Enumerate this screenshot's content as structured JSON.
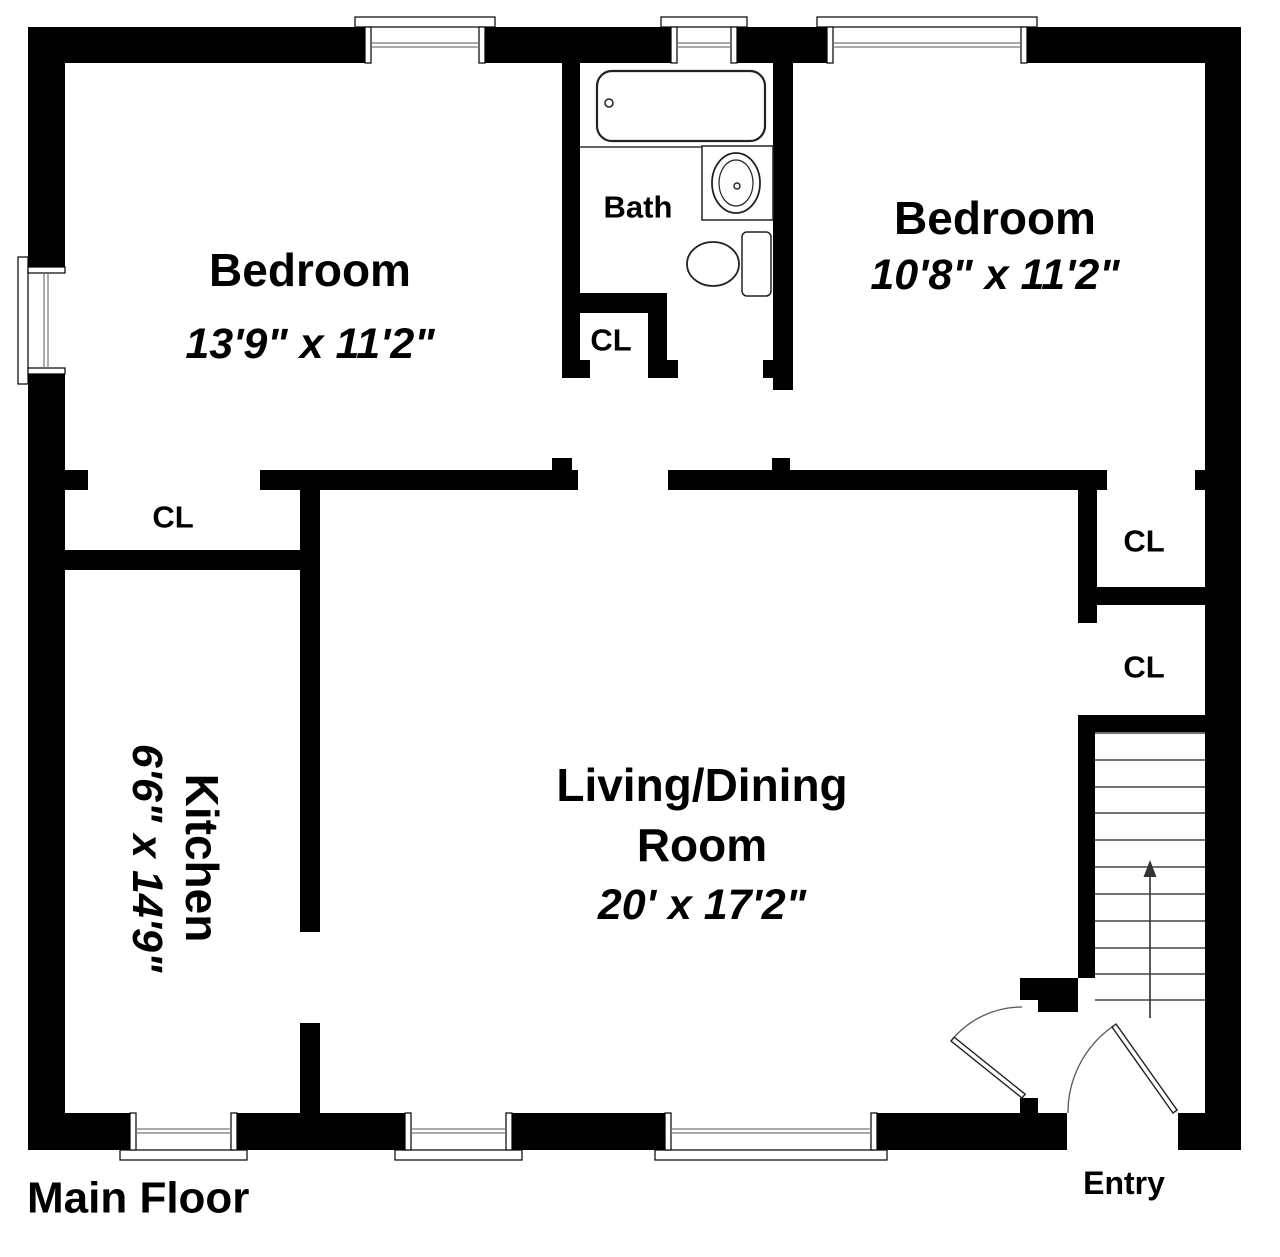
{
  "title": "Main Floor",
  "rooms": {
    "bedroom_left": {
      "name": "Bedroom",
      "dims": "13'9\" x 11'2\""
    },
    "bedroom_right": {
      "name": "Bedroom",
      "dims": "10'8\" x 11'2\""
    },
    "bath": {
      "name": "Bath"
    },
    "kitchen": {
      "name": "Kitchen",
      "dims": "6'6\" x 14'9\""
    },
    "living_dining": {
      "name_line1": "Living/Dining",
      "name_line2": "Room",
      "dims": "20' x 17'2\""
    },
    "entry": {
      "name": "Entry"
    }
  },
  "closets": {
    "bedroom_left_closet": "CL",
    "bath_closet": "CL",
    "bedroom_right_closet": "CL",
    "living_room_closet": "CL"
  },
  "icons": {
    "stairs_direction": "up-arrow"
  },
  "colors": {
    "wall": "#000000",
    "background": "#ffffff",
    "fixture_outline": "#222222",
    "detail_line": "#555555"
  }
}
